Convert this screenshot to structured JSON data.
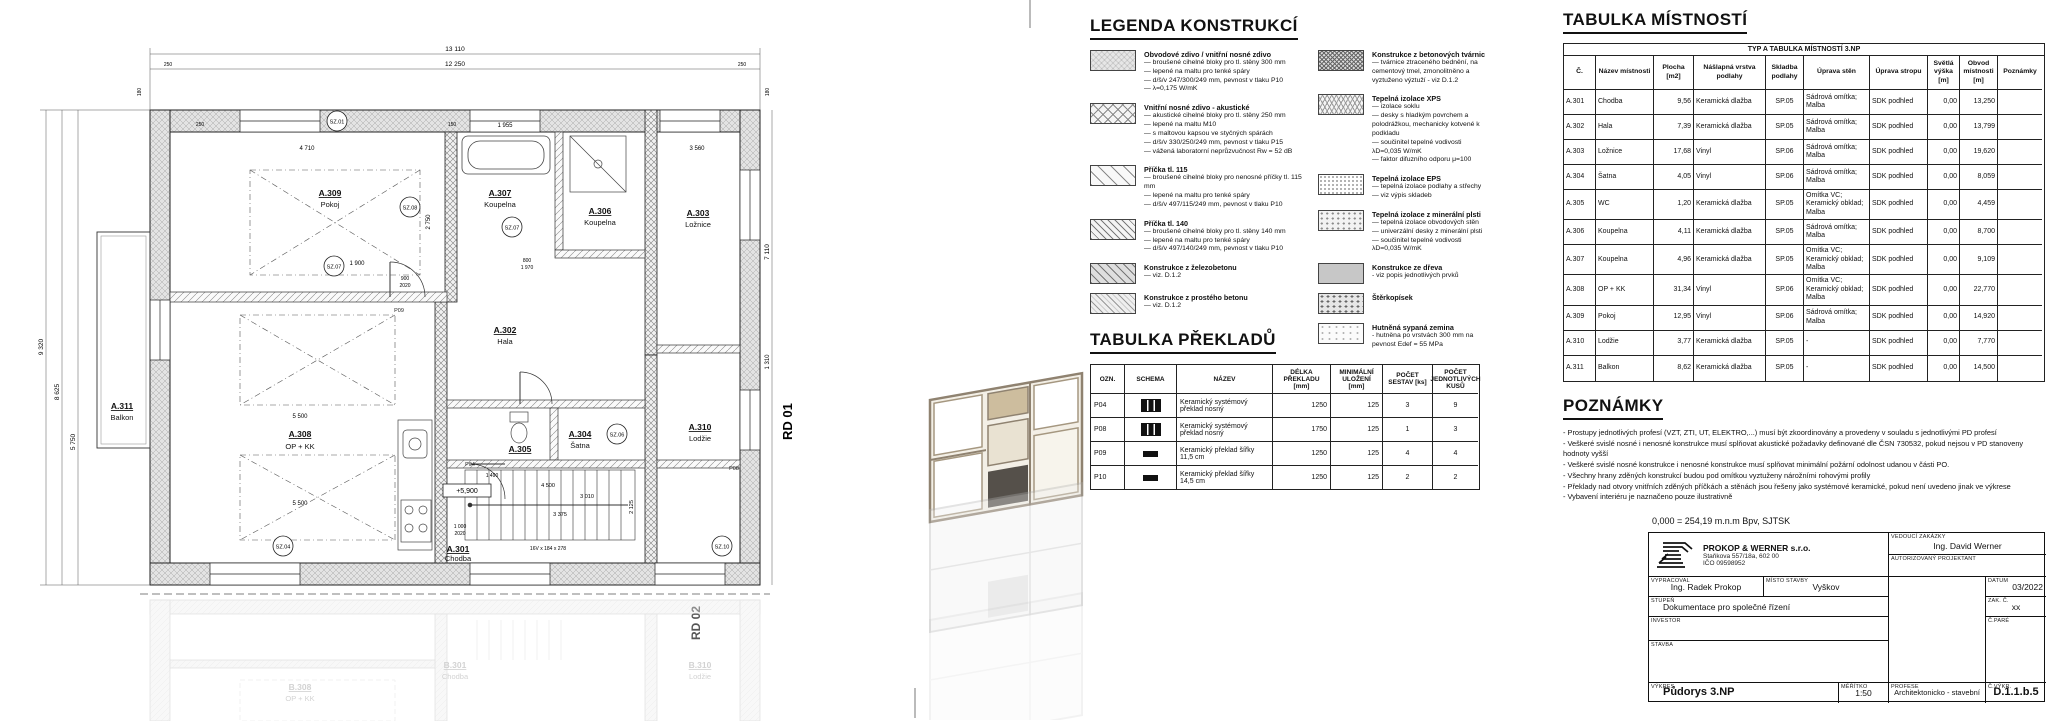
{
  "legend": {
    "title": "LEGENDA KONSTRUKCÍ",
    "col1": [
      {
        "title": "Obvodové zdivo / vnitřní nosné zdivo",
        "pattern": "pat-masonry",
        "lines": "— broušené cihelné bloky pro tl. stěny 300 mm\n— lepené na maltu pro tenké spáry\n— d/š/v 247/300/249 mm, pevnost v tlaku P10\n— λ=0,175 W/mK"
      },
      {
        "title": "Vnitřní nosné zdivo - akustické",
        "pattern": "pat-crosshatch",
        "lines": "— akustické cihelné bloky pro tl. stěny 250 mm\n— lepené na maltu M10\n— s maltovou kapsou ve styčných spárách\n— d/š/v 330/250/249 mm, pevnost v tlaku P15\n— vážená laboratorní neprůzvučnost Rw = 52 dB"
      },
      {
        "title": "Příčka tl. 115",
        "pattern": "pat-hatch-light",
        "lines": "— broušené cihelné bloky pro nenosné příčky tl. 115 mm\n— lepené na maltu pro tenké spáry\n— d/š/v 497/115/249 mm, pevnost v tlaku P10"
      },
      {
        "title": "Příčka tl. 140",
        "pattern": "pat-hatch-dense",
        "lines": "— broušené cihelné bloky pro tl. stěny 140 mm\n— lepené na maltu pro tenké spáry\n— d/š/v 497/140/249 mm, pevnost v tlaku P10"
      },
      {
        "title": "Konstrukce z železobetonu",
        "pattern": "pat-rc",
        "lines": "— viz. D.1.2"
      },
      {
        "title": "Konstrukce z prostého betonu",
        "pattern": "pat-plain-concrete",
        "lines": "— viz. D.1.2"
      }
    ],
    "col2": [
      {
        "title": "Konstrukce z betonových tvárnic",
        "pattern": "pat-block",
        "lines": "— tvárnice ztraceného bednění, na cementový tmel, zmonolitněno a vyztuženo výztuží - viz D.1.2"
      },
      {
        "title": "Tepelná izolace XPS",
        "pattern": "pat-xps",
        "lines": "— izolace soklu\n— desky s hladkým povrchem a polodrážkou, mechanicky kotvené k podkladu\n— součinitel tepelné vodivosti λD=0,035 W/mK\n— faktor difuzního odporu μ=100"
      },
      {
        "title": "Tepelná izolace EPS",
        "pattern": "pat-eps",
        "lines": "— tepelná izolace podlahy a střechy\n— viz výpis skladeb"
      },
      {
        "title": "Tepelná izolace z minerální plsti",
        "pattern": "pat-mineral",
        "lines": "— tepelná izolace obvodových stěn\n— univerzální desky z minerální plsti\n— součinitel tepelné vodivosti λD=0,035 W/mK"
      },
      {
        "title": "Konstrukce ze dřeva",
        "pattern": "pat-wood",
        "lines": "- viz popis jednotlivých prvků"
      },
      {
        "title": "Štěrkopísek",
        "pattern": "pat-gravel",
        "lines": ""
      },
      {
        "title": "Hutněná sypaná zemina",
        "pattern": "pat-soil",
        "lines": "- hutněna po vrstvách 300 mm na pevnost Edef = 55 MPa"
      }
    ]
  },
  "prekladu": {
    "title": "TABULKA PŘEKLADŮ",
    "headers": [
      "OZN.",
      "SCHEMA",
      "NÁZEV",
      "DÉLKA PŘEKLADU [mm]",
      "MINIMÁLNÍ ULOŽENÍ [mm]",
      "POČET SESTAV [ks]",
      "POČET JEDNOTLIVÝCH KUSŮ"
    ],
    "rows": [
      {
        "ozn": "P04",
        "schema": "schema-system",
        "nazev": "Keramický systémový překlad nosný",
        "delka": "1250",
        "ulozeni": "125",
        "sestav": "3",
        "kusu": "9"
      },
      {
        "ozn": "P08",
        "schema": "schema-system",
        "nazev": "Keramický systémový překlad nosný",
        "delka": "1750",
        "ulozeni": "125",
        "sestav": "1",
        "kusu": "3"
      },
      {
        "ozn": "P09",
        "schema": "schema-flat",
        "nazev": "Keramický překlad šířky 11,5 cm",
        "delka": "1250",
        "ulozeni": "125",
        "sestav": "4",
        "kusu": "4"
      },
      {
        "ozn": "P10",
        "schema": "schema-flat",
        "nazev": "Keramický překlad šířky 14,5 cm",
        "delka": "1250",
        "ulozeni": "125",
        "sestav": "2",
        "kusu": "2"
      }
    ]
  },
  "mistnosti": {
    "title": "TABULKA MÍSTNOSTÍ",
    "band": "TYP A TABULKA MÍSTNOSTÍ 3.NP",
    "headers": [
      "Č.",
      "Název místnosti",
      "Plocha [m2]",
      "Nášlapná vrstva podlahy",
      "Skladba podlahy",
      "Úprava stěn",
      "Úprava stropu",
      "Světlá výška [m]",
      "Obvod místnosti [m]",
      "Poznámky"
    ],
    "rows": [
      [
        "A.301",
        "Chodba",
        "9,56",
        "Keramická dlažba",
        "SP.05",
        "Sádrová omítka; Malba",
        "SDK podhled",
        "0,00",
        "13,250",
        ""
      ],
      [
        "A.302",
        "Hala",
        "7,39",
        "Keramická dlažba",
        "SP.05",
        "Sádrová omítka; Malba",
        "SDK podhled",
        "0,00",
        "13,799",
        ""
      ],
      [
        "A.303",
        "Ložnice",
        "17,68",
        "Vinyl",
        "SP.06",
        "Sádrová omítka; Malba",
        "SDK podhled",
        "0,00",
        "19,620",
        ""
      ],
      [
        "A.304",
        "Šatna",
        "4,05",
        "Vinyl",
        "SP.06",
        "Sádrová omítka; Malba",
        "SDK podhled",
        "0,00",
        "8,059",
        ""
      ],
      [
        "A.305",
        "WC",
        "1,20",
        "Keramická dlažba",
        "SP.05",
        "Omítka VC; Keramický obklad; Malba",
        "SDK podhled",
        "0,00",
        "4,459",
        ""
      ],
      [
        "A.306",
        "Koupelna",
        "4,11",
        "Keramická dlažba",
        "SP.05",
        "Sádrová omítka; Malba",
        "SDK podhled",
        "0,00",
        "8,700",
        ""
      ],
      [
        "A.307",
        "Koupelna",
        "4,96",
        "Keramická dlažba",
        "SP.05",
        "Omítka VC; Keramický obklad; Malba",
        "SDK podhled",
        "0,00",
        "9,109",
        ""
      ],
      [
        "A.308",
        "OP + KK",
        "31,34",
        "Vinyl",
        "SP.06",
        "Omítka VC; Keramický obklad; Malba",
        "SDK podhled",
        "0,00",
        "22,770",
        ""
      ],
      [
        "A.309",
        "Pokoj",
        "12,95",
        "Vinyl",
        "SP.06",
        "Sádrová omítka; Malba",
        "SDK podhled",
        "0,00",
        "14,920",
        ""
      ],
      [
        "A.310",
        "Lodžie",
        "3,77",
        "Keramická dlažba",
        "SP.05",
        "-",
        "SDK podhled",
        "0,00",
        "7,770",
        ""
      ],
      [
        "A.311",
        "Balkon",
        "8,62",
        "Keramická dlažba",
        "SP.05",
        "-",
        "SDK podhled",
        "0,00",
        "14,500",
        ""
      ]
    ]
  },
  "poznamky": {
    "title": "POZNÁMKY",
    "lines": [
      "- Prostupy jednotlivých profesí (VZT, ZTI, UT, ELEKTRO,...) musí být zkoordinovány a provedeny v souladu s jednotlivými PD profesí",
      "- Veškeré svislé nosné i nenosné konstrukce musí splňovat akustické požadavky definované dle ČSN 730532, pokud nejsou v PD stanoveny hodnoty vyšší",
      "- Veškeré svislé nosné konstrukce i nenosné konstrukce musí splňovat minimální požární odolnost udanou v části PO.",
      "- Všechny hrany zděných konstrukcí budou pod omítkou vyztuženy nárožními rohovými profily",
      "- Překlady nad otvory vnitřních zděných příčkách a stěnách jsou řešeny jako systémové keramické, pokud není uvedeno jinak ve výkrese",
      "- Vybavení interiéru je naznačeno pouze ilustrativně"
    ]
  },
  "titleblock": {
    "elevation_note": "0,000 = 254,19 m.n.m Bpv, SJTSK",
    "company": {
      "name": "PROKOP & WERNER s.r.o.",
      "address": "Staňkova 557/18a, 602 00",
      "ico": "IČO 09598952"
    },
    "vedouci_label": "VEDOUCÍ ZAKÁZKY",
    "vedouci": "Ing. David Werner",
    "autorizovany_label": "AUTORIZOVANÝ PROJEKTANT",
    "vypracoval_label": "VYPRACOVAL",
    "vypracoval": "Ing. Radek Prokop",
    "misto_label": "MÍSTO STAVBY",
    "misto": "Vyškov",
    "datum_label": "DATUM",
    "datum": "03/2022",
    "stupen_label": "STUPEŇ",
    "stupen": "Dokumentace pro společné řízení",
    "zakc_label": "ZAK. Č.",
    "zakc": "xx",
    "investor_label": "INVESTOR",
    "cpare_label": "Č.PARÉ",
    "stavba_label": "STAVBA",
    "vykres_label": "VÝKRES",
    "vykres": "Půdorys 3.NP",
    "meritko_label": "MĚŘÍTKO",
    "meritko": "1:50",
    "profese_label": "PROFESE",
    "profese": "Architektonicko - stavební",
    "cvykr_label": "Č.VÝKR.",
    "cvykr": "D.1.1.b.5"
  },
  "plan": {
    "rooms": [
      {
        "id": "A.309",
        "name": "Pokoj"
      },
      {
        "id": "A.307",
        "name": "Koupelna"
      },
      {
        "id": "A.306",
        "name": "Koupelna"
      },
      {
        "id": "A.303",
        "name": "Ložnice"
      },
      {
        "id": "A.302",
        "name": "Hala"
      },
      {
        "id": "A.305",
        "name": ""
      },
      {
        "id": "A.304",
        "name": "Šatna"
      },
      {
        "id": "A.301",
        "name": "Chodba"
      },
      {
        "id": "A.310",
        "name": "Lodžie"
      },
      {
        "id": "A.308",
        "name": "OP + KK"
      },
      {
        "id": "A.311",
        "name": "Balkon"
      }
    ],
    "ghost_rooms": [
      {
        "id": "B.308",
        "name": "OP + KK"
      },
      {
        "id": "B.301",
        "name": "Chodba"
      },
      {
        "id": "B.310",
        "name": "Lodžie"
      }
    ],
    "unit_labels": {
      "rd01": "RD 01",
      "rd02": "RD 02"
    },
    "markers": [
      "SZ.01",
      "SZ.08",
      "SZ.07",
      "SZ.07",
      "SZ.06",
      "SZ.04",
      "SZ.10"
    ],
    "lintel_marks": [
      "P09",
      "P04",
      "P08"
    ],
    "level_label": "+5,900",
    "stair_label": "16V x 184 x 278",
    "dims": {
      "top_total": "13 110",
      "top_inner": "12 250",
      "seg_left": "250",
      "seg_right": "250",
      "edge_left": "180",
      "edge_right": "180",
      "left": [
        "9 320",
        "8 625",
        "5 750"
      ],
      "right": [
        "7 110",
        "1 310"
      ],
      "inner": [
        "4 710",
        "1 955",
        "3 560",
        "2 750",
        "1 900",
        "900",
        "2020",
        "800",
        "1 970",
        "5 500",
        "5 500",
        "1 490",
        "4 500",
        "3 010",
        "3 375",
        "2 125",
        "1 000",
        "2020",
        "150",
        "250"
      ]
    }
  }
}
